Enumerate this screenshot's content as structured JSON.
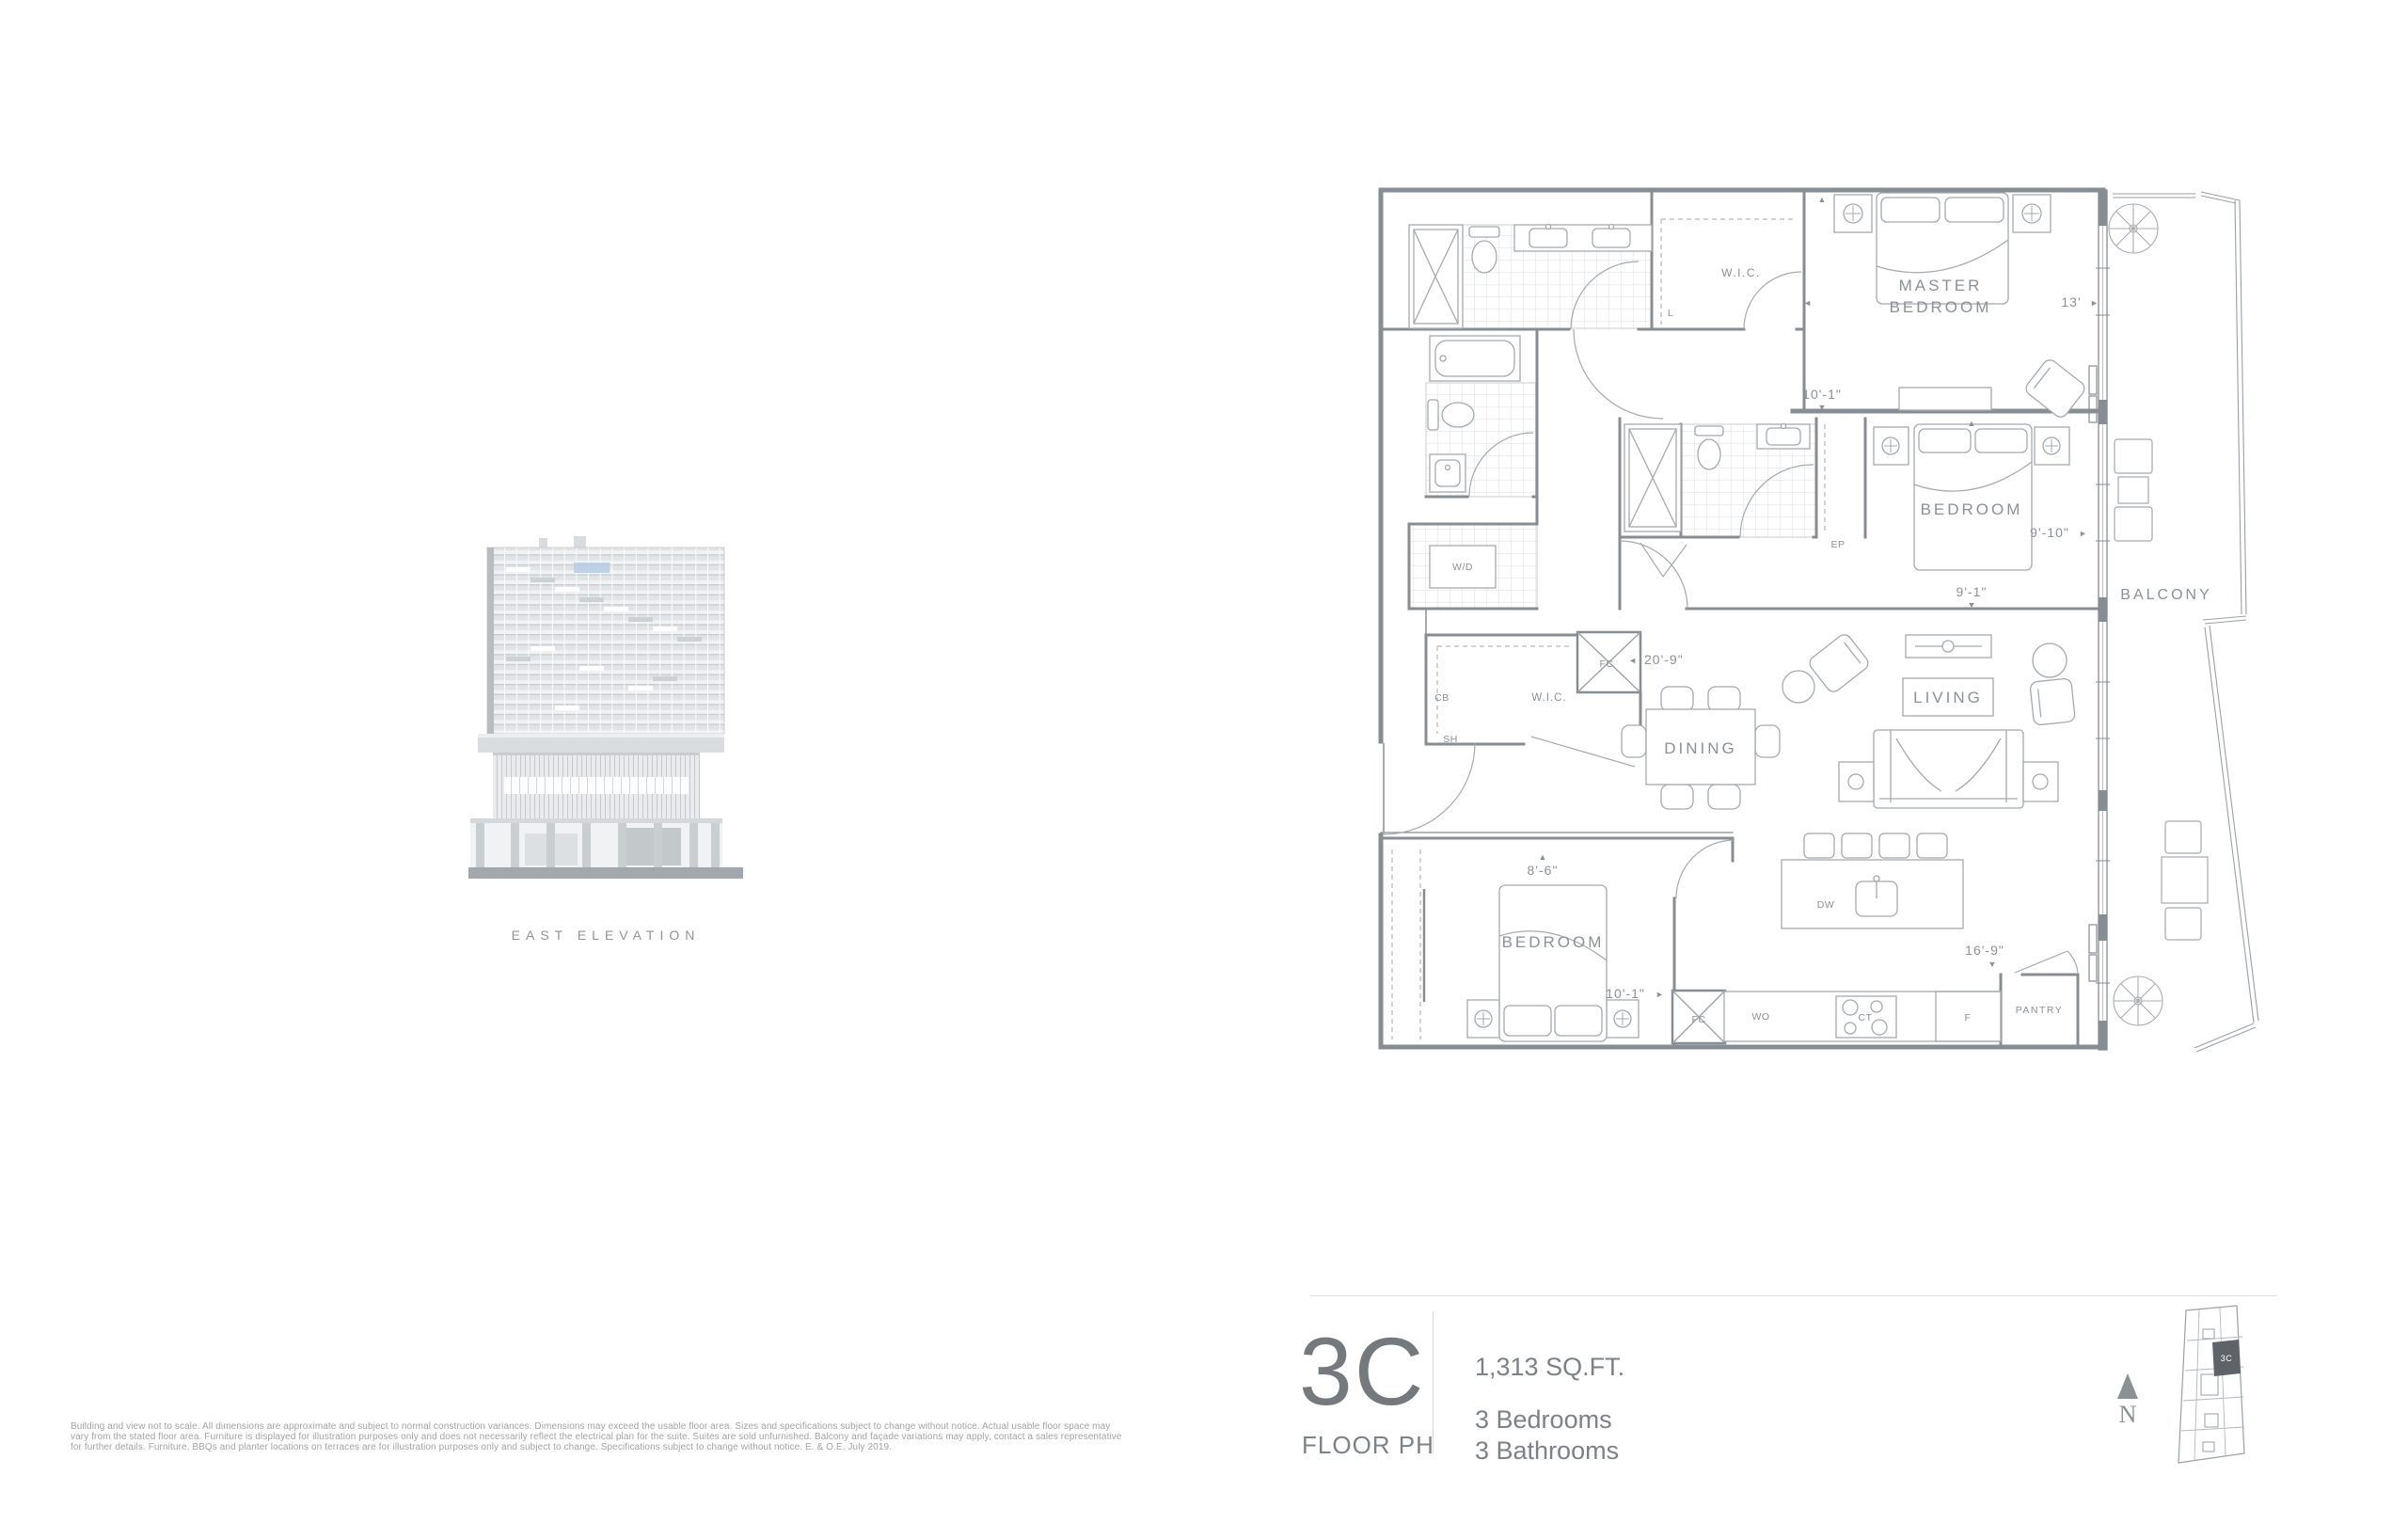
{
  "elevation": {
    "caption": "EAST ELEVATION"
  },
  "floor_plan": {
    "room_labels": {
      "master_line1": "MASTER",
      "master_line2": "BEDROOM",
      "wic_master": "W.I.C.",
      "wic_foyer": "W.I.C.",
      "bedroom2": "BEDROOM",
      "bedroom3": "BEDROOM",
      "living": "LIVING",
      "dining": "DINING",
      "balcony": "BALCONY",
      "pantry": "PANTRY",
      "laundry": "W/D"
    },
    "fixture_labels": {
      "linen": "L",
      "electrical_panel": "EP",
      "fan_coil_closet": "FC",
      "fan_coil_kitchen": "FC",
      "cb": "CB",
      "sh": "SH",
      "wall_oven": "WO",
      "cooktop": "CT",
      "fridge": "F",
      "dishwasher": "DW"
    },
    "dimensions": {
      "master_width": "13'",
      "master_depth": "10'-1\"",
      "bedroom2_width": "9'-10\"",
      "bedroom2_depth": "9'-1\"",
      "great_room_width": "20'-9\"",
      "bedroom3_width": "8'-6\"",
      "bedroom3_depth": "10'-1\"",
      "kitchen_run": "16'-9\""
    },
    "icons": {
      "arrow_right": "►",
      "arrow_left": "◄",
      "arrow_up": "▲",
      "arrow_down": "▼"
    }
  },
  "unit_summary": {
    "unit_code": "3C",
    "floor_label": "FLOOR PH",
    "area": "1,313 SQ.FT.",
    "bedrooms": "3 Bedrooms",
    "bathrooms": "3 Bathrooms"
  },
  "key_plan": {
    "unit_code": "3C",
    "north_label": "N"
  },
  "disclaimer": "Building and view not to scale. All dimensions are approximate and subject to normal construction variances. Dimensions may exceed the usable floor area. Sizes and specifications subject to change without notice. Actual usable floor space may vary from the stated floor area. Furniture is displayed for illustration purposes only and does not necessarily reflect the electrical plan for the suite. Suites are sold unfurnished. Balcony and façade variations may apply, contact a sales representative for further details. Furniture, BBQs and planter locations on terraces are for illustration purposes only and subject to change. Specifications subject to change without notice. E. & O.E. July 2019.",
  "colors": {
    "wall_line": "#868d93",
    "furniture_line": "#a4aaaf",
    "text_gray": "#8b9197",
    "highlight_blue": "#b6cce4",
    "keyplan_unit_fill": "#5d6368"
  }
}
